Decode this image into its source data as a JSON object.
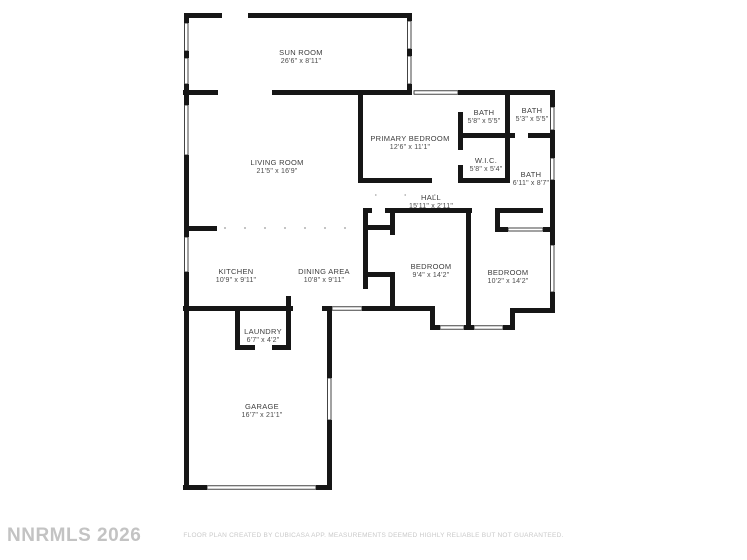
{
  "plan": {
    "watermark": "NNRMLS 2026",
    "disclaimer": "FLOOR PLAN CREATED BY CUBICASA APP. MEASUREMENTS DEEMED HIGHLY RELIABLE BUT NOT GUARANTEED.",
    "wall_color": "#161616",
    "label_color": "#3d3d3d",
    "rooms": [
      {
        "id": "sun-room",
        "name": "SUN ROOM",
        "dims": "26'6\" x 8'11\"",
        "cx": 301,
        "cy": 57
      },
      {
        "id": "living-room",
        "name": "LIVING ROOM",
        "dims": "21'5\" x 16'9\"",
        "cx": 277,
        "cy": 167
      },
      {
        "id": "primary-bedroom",
        "name": "PRIMARY BEDROOM",
        "dims": "12'6\" x 11'1\"",
        "cx": 410,
        "cy": 143
      },
      {
        "id": "bath-1",
        "name": "BATH",
        "dims": "5'8\" x 5'5\"",
        "cx": 484,
        "cy": 117
      },
      {
        "id": "bath-2",
        "name": "BATH",
        "dims": "5'3\" x 5'5\"",
        "cx": 532,
        "cy": 115
      },
      {
        "id": "wic",
        "name": "W.I.C.",
        "dims": "5'8\" x 5'4\"",
        "cx": 486,
        "cy": 165
      },
      {
        "id": "bath-3",
        "name": "BATH",
        "dims": "6'11\" x 8'7\"",
        "cx": 531,
        "cy": 179
      },
      {
        "id": "hall",
        "name": "HALL",
        "dims": "15'11\" x 2'11\"",
        "cx": 431,
        "cy": 202
      },
      {
        "id": "kitchen",
        "name": "KITCHEN",
        "dims": "10'9\" x 9'11\"",
        "cx": 236,
        "cy": 276
      },
      {
        "id": "dining-area",
        "name": "DINING AREA",
        "dims": "10'8\" x 9'11\"",
        "cx": 324,
        "cy": 276
      },
      {
        "id": "bedroom-1",
        "name": "BEDROOM",
        "dims": "9'4\" x 14'2\"",
        "cx": 431,
        "cy": 271
      },
      {
        "id": "bedroom-2",
        "name": "BEDROOM",
        "dims": "10'2\" x 14'2\"",
        "cx": 508,
        "cy": 277
      },
      {
        "id": "laundry",
        "name": "LAUNDRY",
        "dims": "6'7\" x 4'2\"",
        "cx": 263,
        "cy": 336
      },
      {
        "id": "garage",
        "name": "GARAGE",
        "dims": "16'7\" x 21'1\"",
        "cx": 262,
        "cy": 411
      }
    ]
  }
}
